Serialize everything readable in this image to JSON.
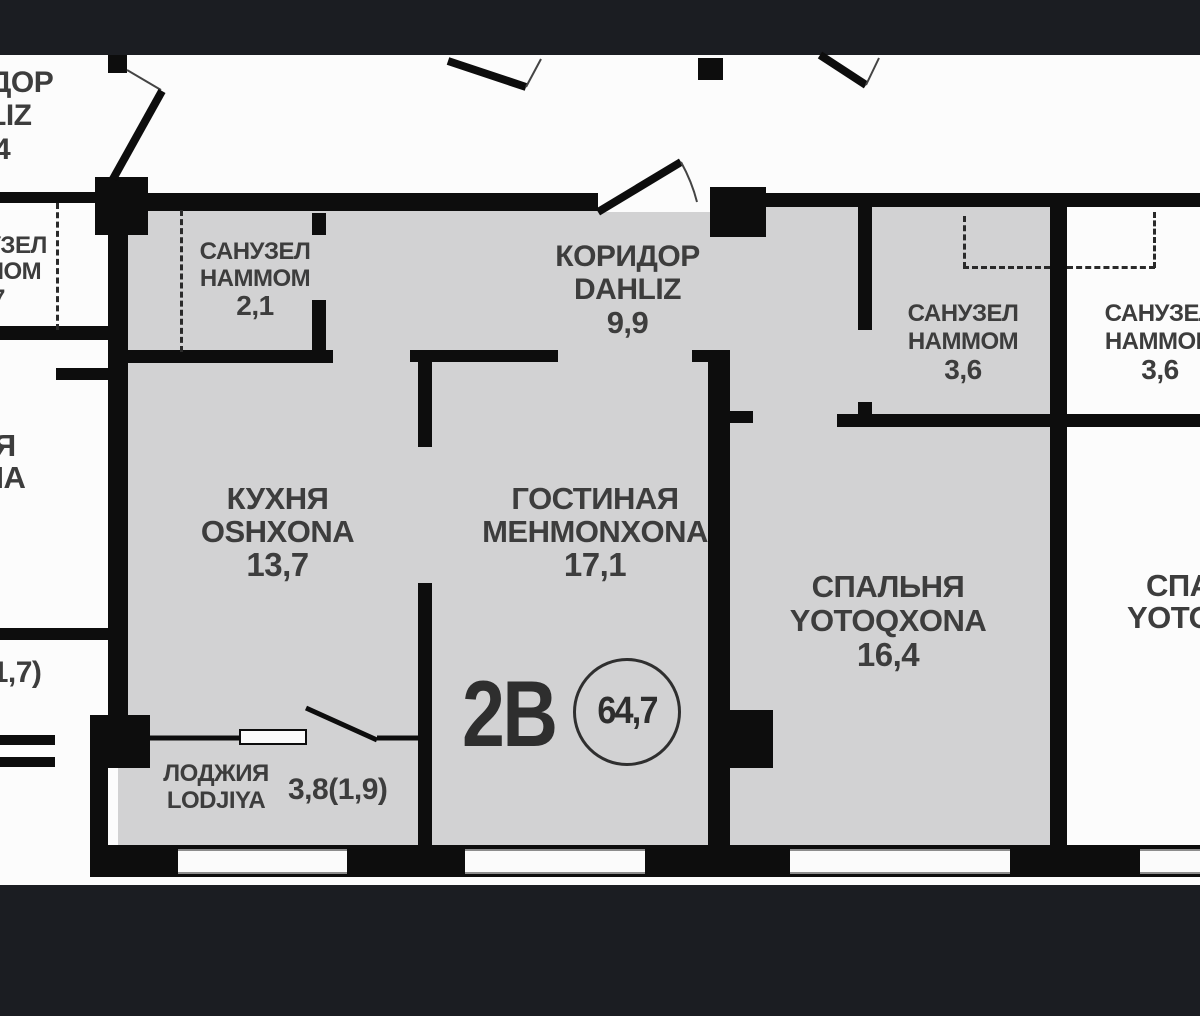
{
  "unit": {
    "number": "2В",
    "total_area": "64,7"
  },
  "rooms": {
    "bathroom_small": {
      "name_ru": "САНУЗЕЛ",
      "name_uz": "HAMMOM",
      "area": "2,1"
    },
    "corridor": {
      "name_ru": "КОРИДОР",
      "name_uz": "DAHLIZ",
      "area": "9,9"
    },
    "kitchen": {
      "name_ru": "КУХНЯ",
      "name_uz": "OSHXONA",
      "area": "13,7"
    },
    "living_room": {
      "name_ru": "ГОСТИНАЯ",
      "name_uz": "MEHMONXONA",
      "area": "17,1"
    },
    "bedroom": {
      "name_ru": "СПАЛЬНЯ",
      "name_uz": "YOTOQXONA",
      "area": "16,4"
    },
    "bathroom_main": {
      "name_ru": "САНУЗЕЛ",
      "name_uz": "HAMMOM",
      "area": "3,6"
    },
    "bathroom_neighbor": {
      "name_ru": "САНУЗЕЛ",
      "name_uz": "HAMMOM",
      "area": "3,6"
    },
    "loggia": {
      "name_ru": "ЛОДЖИЯ",
      "name_uz": "LODJIYA",
      "area": "3,8(1,9)"
    }
  },
  "neighbor_partials": {
    "top_corridor_ru": "ДОР",
    "top_corridor_uz": "LIZ",
    "top_corridor_area": "4",
    "left_bath_ru": "УЗЕЛ",
    "left_bath_uz": "МОМ",
    "left_bath_area": "7",
    "left_kitchen_ru": "НЯ",
    "left_kitchen_uz": "ONA",
    "left_loggia_area": "3,4(1,7)",
    "right_bedroom_ru": "СПАЛЬНЯ",
    "right_bedroom_uz": "YOTOQXONA"
  },
  "colors": {
    "page_background": "#1b1d22",
    "outside_floor": "#fcfcfc",
    "apartment_floor": "#d2d2d3",
    "walls": "#0d0d0d",
    "text": "#3d3d3d"
  }
}
